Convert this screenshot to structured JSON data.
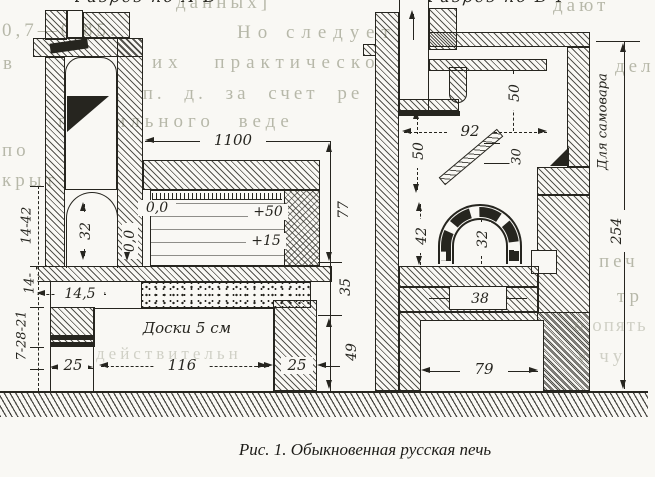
{
  "caption": "Рис. 1. Обыкновенная русская печь",
  "titles": {
    "left": "Разрез по А-Б",
    "right": "Разрез по В-Г"
  },
  "left_stove": {
    "width_1100": "1100",
    "flue_32": "32",
    "zero_a": "0,0",
    "zero_b": "0,0",
    "plus_50": "+50",
    "plus_15": "+15",
    "shelf_14_5": "14,5",
    "chain_14_42": "14-42",
    "chain_14": "14-",
    "chain_7_28_21": "7-28-21",
    "right_77": "77",
    "right_35": "35",
    "right_49": "49",
    "pier_left_25": "25",
    "boards_116": "116",
    "pier_right_25": "25",
    "boards_label": "Доски 5 см"
  },
  "right_stove": {
    "ch_50_top": "50",
    "w_92": "92",
    "ch_50_left": "50",
    "damper_30": "30",
    "samovar": "Для самовара",
    "total_254": "254",
    "mouth_42": "42",
    "arch_32": "32",
    "vent_38": "38",
    "base_79": "79"
  },
  "overlay": {
    "l1a": "данных]",
    "l1b": "дают",
    "l2a": "0,7—0,85.",
    "l2b": "Но следует",
    "l3a": "в",
    "l3b": "их практическо",
    "l4": "к. п. д. за счет ре",
    "l5": "правильного веде",
    "l6": "по",
    "l7": "крыт",
    "r0": "дел",
    "r1": "печ",
    "r2": "тр",
    "r3": "о опять",
    "r4": "у чу",
    "b1": "действительн"
  },
  "colors": {
    "ink": "#26251f",
    "paper": "#f9f8f4",
    "overlay_text": "#8f927c"
  }
}
